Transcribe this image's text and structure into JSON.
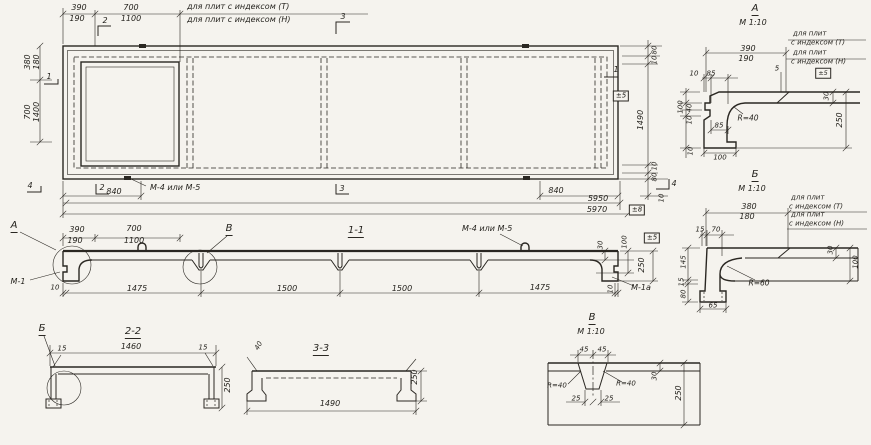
{
  "colors": {
    "ink": "#2a2722",
    "paper": "#f5f3ee"
  },
  "views": {
    "plan": {
      "labels": [
        {
          "n": "dim-390-top",
          "t": "390",
          "x": 79,
          "y": 8
        },
        {
          "n": "dim-190-top",
          "t": "190",
          "x": 77,
          "y": 19
        },
        {
          "n": "dim-700-top",
          "t": "700",
          "x": 131,
          "y": 8
        },
        {
          "n": "dim-1100-top",
          "t": "1100",
          "x": 131,
          "y": 19
        },
        {
          "n": "note-plates-index-t",
          "t": "для плит с индексом (Т)",
          "x": 187,
          "y": 7,
          "a": "s"
        },
        {
          "n": "note-plates-index-n",
          "t": "для плит с индексом (Н)",
          "x": 187,
          "y": 20,
          "a": "s"
        },
        {
          "n": "section-mark-2-top",
          "t": "2",
          "x": 105,
          "y": 21
        },
        {
          "n": "section-mark-3-top",
          "t": "3",
          "x": 343,
          "y": 17
        },
        {
          "n": "dim-380-left",
          "t": "380",
          "x": 28,
          "y": 62,
          "r": -90
        },
        {
          "n": "dim-180-left",
          "t": "180",
          "x": 37,
          "y": 62,
          "r": -90
        },
        {
          "n": "section-mark-1-left",
          "t": "1",
          "x": 49,
          "y": 77
        },
        {
          "n": "dim-700-left",
          "t": "700",
          "x": 28,
          "y": 112,
          "r": -90
        },
        {
          "n": "dim-1400-left",
          "t": "1400",
          "x": 37,
          "y": 112,
          "r": -90
        },
        {
          "n": "section-mark-4-left",
          "t": "4",
          "x": 30,
          "y": 186
        },
        {
          "n": "section-mark-2-bottom",
          "t": "2",
          "x": 102,
          "y": 188
        },
        {
          "n": "dim-840-left",
          "t": "840",
          "x": 114,
          "y": 192
        },
        {
          "n": "callout-m4-m5-plan",
          "t": "М-4 или М-5",
          "x": 150,
          "y": 188,
          "a": "s"
        },
        {
          "n": "section-mark-3-bottom",
          "t": "3",
          "x": 342,
          "y": 189
        },
        {
          "n": "dim-5950",
          "t": "5950",
          "x": 598,
          "y": 199
        },
        {
          "n": "dim-5970",
          "t": "5970",
          "x": 597,
          "y": 210
        },
        {
          "n": "tol-plus-minus-8",
          "t": "±8",
          "x": 637,
          "y": 210,
          "b": 1,
          "s": 7
        },
        {
          "n": "dim-840-right",
          "t": "840",
          "x": 556,
          "y": 191
        },
        {
          "n": "dim-80-right-top",
          "t": "80",
          "x": 655,
          "y": 50,
          "r": -90,
          "s": 7
        },
        {
          "n": "dim-10-right-top",
          "t": "10",
          "x": 655,
          "y": 60,
          "r": -90,
          "s": 7
        },
        {
          "n": "section-mark-1-right",
          "t": "1",
          "x": 616,
          "y": 70
        },
        {
          "n": "tol-plus-minus-5-plan",
          "t": "±5",
          "x": 621,
          "y": 96,
          "b": 1,
          "s": 7
        },
        {
          "n": "dim-1490-right",
          "t": "1490",
          "x": 641,
          "y": 120,
          "r": -90
        },
        {
          "n": "dim-10-right-bottom",
          "t": "10",
          "x": 655,
          "y": 166,
          "r": -90,
          "s": 7
        },
        {
          "n": "dim-80-right-bottom",
          "t": "80",
          "x": 655,
          "y": 177,
          "r": -90,
          "s": 7
        },
        {
          "n": "section-mark-4-right",
          "t": "4",
          "x": 674,
          "y": 184
        },
        {
          "n": "dim-10-right-outer",
          "t": "10",
          "x": 662,
          "y": 198,
          "r": -90,
          "s": 7
        }
      ]
    },
    "section_1_1": {
      "labels": [
        {
          "n": "detail-callout-a",
          "t": "А",
          "x": 14,
          "y": 227,
          "u": 1,
          "s": 10
        },
        {
          "n": "dim-390",
          "t": "390",
          "x": 77,
          "y": 230
        },
        {
          "n": "dim-190",
          "t": "190",
          "x": 75,
          "y": 241
        },
        {
          "n": "dim-700",
          "t": "700",
          "x": 134,
          "y": 229
        },
        {
          "n": "dim-1100",
          "t": "1100",
          "x": 134,
          "y": 241
        },
        {
          "n": "detail-callout-v",
          "t": "В",
          "x": 229,
          "y": 230,
          "u": 1,
          "s": 10
        },
        {
          "n": "section-title",
          "t": "1-1",
          "x": 356,
          "y": 232,
          "u": 1,
          "s": 10
        },
        {
          "n": "callout-m4-m5",
          "t": "М-4 или М-5",
          "x": 462,
          "y": 229,
          "a": "s"
        },
        {
          "n": "callout-m1",
          "t": "М-1",
          "x": 18,
          "y": 282
        },
        {
          "n": "dim-10-left",
          "t": "10",
          "x": 55,
          "y": 288,
          "s": 7
        },
        {
          "n": "dim-1475-left",
          "t": "1475",
          "x": 137,
          "y": 289
        },
        {
          "n": "dim-1500-left",
          "t": "1500",
          "x": 287,
          "y": 289
        },
        {
          "n": "dim-1500-right",
          "t": "1500",
          "x": 402,
          "y": 289
        },
        {
          "n": "dim-1475-right",
          "t": "1475",
          "x": 540,
          "y": 288
        },
        {
          "n": "dim-10-right",
          "t": "10",
          "x": 611,
          "y": 289,
          "r": -90,
          "s": 7
        },
        {
          "n": "callout-m1a",
          "t": "М-1а",
          "x": 641,
          "y": 288
        },
        {
          "n": "dim-30-right",
          "t": "30",
          "x": 601,
          "y": 245,
          "r": -90,
          "s": 7
        },
        {
          "n": "dim-100-right",
          "t": "100",
          "x": 625,
          "y": 242,
          "r": -90,
          "s": 7
        },
        {
          "n": "tol-plus-minus-5",
          "t": "±5",
          "x": 652,
          "y": 238,
          "b": 1,
          "s": 7
        },
        {
          "n": "dim-250-right",
          "t": "250",
          "x": 642,
          "y": 265,
          "r": -90
        }
      ]
    },
    "section_2_2": {
      "labels": [
        {
          "n": "detail-callout-b",
          "t": "Б",
          "x": 42,
          "y": 330,
          "u": 1,
          "s": 10
        },
        {
          "n": "section-title",
          "t": "2-2",
          "x": 133,
          "y": 333,
          "u": 1,
          "s": 10
        },
        {
          "n": "dim-1460",
          "t": "1460",
          "x": 131,
          "y": 347
        },
        {
          "n": "dim-15-left",
          "t": "15",
          "x": 62,
          "y": 349,
          "s": 7
        },
        {
          "n": "dim-15-right",
          "t": "15",
          "x": 203,
          "y": 348,
          "s": 7
        },
        {
          "n": "dim-250",
          "t": "250",
          "x": 228,
          "y": 385,
          "r": -90
        }
      ]
    },
    "section_3_3": {
      "labels": [
        {
          "n": "dim-40",
          "t": "40",
          "x": 259,
          "y": 346,
          "r": -60,
          "s": 7
        },
        {
          "n": "section-title",
          "t": "3-3",
          "x": 321,
          "y": 350,
          "u": 1,
          "s": 10
        },
        {
          "n": "dim-250",
          "t": "250",
          "x": 415,
          "y": 377,
          "r": -90
        },
        {
          "n": "dim-1490",
          "t": "1490",
          "x": 330,
          "y": 404
        }
      ]
    },
    "detail_v": {
      "labels": [
        {
          "n": "detail-title",
          "t": "В",
          "x": 592,
          "y": 319,
          "u": 1,
          "s": 10
        },
        {
          "n": "detail-scale",
          "t": "М 1:10",
          "x": 591,
          "y": 332
        },
        {
          "n": "dim-45-left",
          "t": "45",
          "x": 584,
          "y": 350,
          "s": 7
        },
        {
          "n": "dim-45-right",
          "t": "45",
          "x": 602,
          "y": 350,
          "s": 7
        },
        {
          "n": "radius-40-left",
          "t": "R=40",
          "x": 557,
          "y": 386,
          "s": 7
        },
        {
          "n": "radius-40-right",
          "t": "R=40",
          "x": 626,
          "y": 384,
          "s": 7
        },
        {
          "n": "dim-25-left",
          "t": "25",
          "x": 576,
          "y": 399,
          "s": 7
        },
        {
          "n": "dim-25-right",
          "t": "25",
          "x": 609,
          "y": 399,
          "s": 7
        },
        {
          "n": "dim-30",
          "t": "30",
          "x": 655,
          "y": 376,
          "r": -90,
          "s": 7
        },
        {
          "n": "dim-250",
          "t": "250",
          "x": 679,
          "y": 393,
          "r": -90
        }
      ]
    },
    "detail_a": {
      "labels": [
        {
          "n": "detail-title",
          "t": "А",
          "x": 755,
          "y": 10,
          "u": 1,
          "s": 10
        },
        {
          "n": "detail-scale",
          "t": "М 1:10",
          "x": 753,
          "y": 23
        },
        {
          "n": "note-line-1",
          "t": "для плит",
          "x": 793,
          "y": 34,
          "a": "s",
          "s": 7
        },
        {
          "n": "note-line-2",
          "t": "с индексом (Т)",
          "x": 791,
          "y": 43,
          "a": "s",
          "s": 7
        },
        {
          "n": "note-line-3",
          "t": "для плит",
          "x": 793,
          "y": 53,
          "a": "s",
          "s": 7
        },
        {
          "n": "note-line-4",
          "t": "с индексом (Н)",
          "x": 791,
          "y": 62,
          "a": "s",
          "s": 7
        },
        {
          "n": "dim-390",
          "t": "390",
          "x": 748,
          "y": 49
        },
        {
          "n": "dim-190",
          "t": "190",
          "x": 746,
          "y": 59
        },
        {
          "n": "dim-5",
          "t": "5",
          "x": 777,
          "y": 69,
          "s": 7
        },
        {
          "n": "tol-plus-minus-5",
          "t": "±5",
          "x": 823,
          "y": 73,
          "b": 1,
          "s": 6.5
        },
        {
          "n": "dim-10-top",
          "t": "10",
          "x": 694,
          "y": 74,
          "s": 7
        },
        {
          "n": "dim-85-top",
          "t": "85",
          "x": 711,
          "y": 74,
          "s": 7
        },
        {
          "n": "dim-30-right",
          "t": "30",
          "x": 827,
          "y": 96,
          "r": -90,
          "s": 7
        },
        {
          "n": "dim-100-left",
          "t": "100",
          "x": 681,
          "y": 107,
          "r": -90,
          "s": 7
        },
        {
          "n": "dim-40-left",
          "t": "40",
          "x": 690,
          "y": 108,
          "r": -90,
          "s": 7
        },
        {
          "n": "dim-10-left",
          "t": "10",
          "x": 690,
          "y": 120,
          "r": -90,
          "s": 7
        },
        {
          "n": "radius-40",
          "t": "R=40",
          "x": 748,
          "y": 118,
          "s": 7.5
        },
        {
          "n": "dim-85-mid",
          "t": "85",
          "x": 719,
          "y": 126,
          "s": 7
        },
        {
          "n": "dim-10-foot",
          "t": "10",
          "x": 691,
          "y": 151,
          "r": -90,
          "s": 7
        },
        {
          "n": "dim-100-foot",
          "t": "100",
          "x": 720,
          "y": 158,
          "s": 7
        },
        {
          "n": "dim-250-right",
          "t": "250",
          "x": 840,
          "y": 120,
          "r": -90
        }
      ]
    },
    "detail_b": {
      "labels": [
        {
          "n": "detail-title",
          "t": "Б",
          "x": 755,
          "y": 176,
          "u": 1,
          "s": 10
        },
        {
          "n": "detail-scale",
          "t": "М 1:10",
          "x": 752,
          "y": 189
        },
        {
          "n": "note-line-1",
          "t": "для плит",
          "x": 791,
          "y": 198,
          "a": "s",
          "s": 7
        },
        {
          "n": "note-line-2",
          "t": "с индексом (Т)",
          "x": 789,
          "y": 207,
          "a": "s",
          "s": 7
        },
        {
          "n": "note-line-3",
          "t": "для плит",
          "x": 791,
          "y": 215,
          "a": "s",
          "s": 7
        },
        {
          "n": "note-line-4",
          "t": "с индексом (Н)",
          "x": 789,
          "y": 224,
          "a": "s",
          "s": 7
        },
        {
          "n": "dim-380",
          "t": "380",
          "x": 749,
          "y": 207
        },
        {
          "n": "dim-180",
          "t": "180",
          "x": 747,
          "y": 217
        },
        {
          "n": "dim-15-top",
          "t": "15",
          "x": 700,
          "y": 230,
          "s": 7
        },
        {
          "n": "dim-70-top",
          "t": "70",
          "x": 716,
          "y": 230,
          "s": 7
        },
        {
          "n": "dim-145-left",
          "t": "145",
          "x": 684,
          "y": 262,
          "r": -90,
          "s": 7
        },
        {
          "n": "dim-15-left",
          "t": "15",
          "x": 682,
          "y": 282,
          "r": -90,
          "s": 7
        },
        {
          "n": "dim-80-left",
          "t": "80",
          "x": 684,
          "y": 294,
          "r": -90,
          "s": 7
        },
        {
          "n": "dim-65-foot",
          "t": "65",
          "x": 713,
          "y": 306,
          "s": 7
        },
        {
          "n": "radius-60",
          "t": "R=60",
          "x": 759,
          "y": 283,
          "s": 7.5
        },
        {
          "n": "dim-30-right",
          "t": "30",
          "x": 831,
          "y": 250,
          "r": -90,
          "s": 7
        },
        {
          "n": "dim-100-right",
          "t": "100",
          "x": 856,
          "y": 262,
          "r": -90,
          "s": 7
        }
      ]
    }
  }
}
